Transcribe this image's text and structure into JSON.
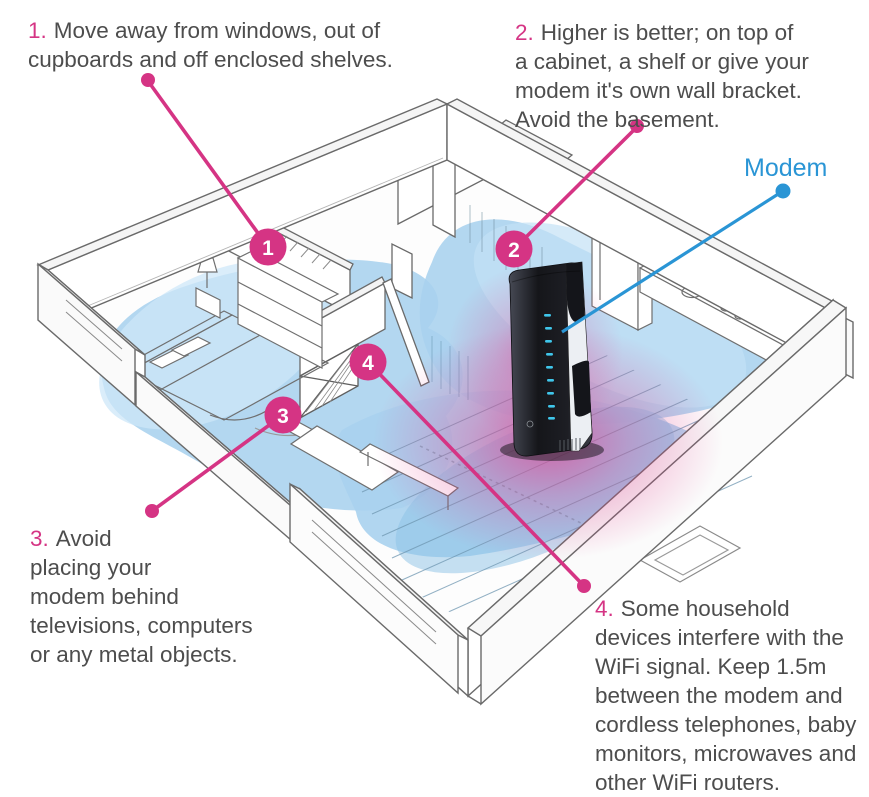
{
  "title": "Modem placement tips",
  "colors": {
    "accent_pink": "#d53484",
    "accent_blue": "#2a95d5",
    "wifi_blue": "#a8d2ee",
    "wifi_blue_light": "#cde7f8",
    "wifi_blue_deep": "#8cc2e6",
    "text": "#4d4d4d"
  },
  "modem_label": "Modem",
  "callouts": [
    {
      "num": "1.",
      "circle": "1",
      "text": "Move away from windows, out of\ncupboards and off enclosed shelves."
    },
    {
      "num": "2.",
      "circle": "2",
      "text": "Higher is better; on top of\na cabinet, a shelf or give your\nmodem it's own wall bracket.\nAvoid the basement."
    },
    {
      "num": "3.",
      "circle": "3",
      "text": "Avoid\nplacing your\nmodem behind\ntelevisions, computers\nor any metal objects."
    },
    {
      "num": "4.",
      "circle": "4",
      "text": "Some household\ndevices interfere with the\nWiFi signal. Keep 1.5m\nbetween the modem and\ncordless telephones, baby\nmonitors, microwaves and\nother WiFi routers."
    }
  ]
}
